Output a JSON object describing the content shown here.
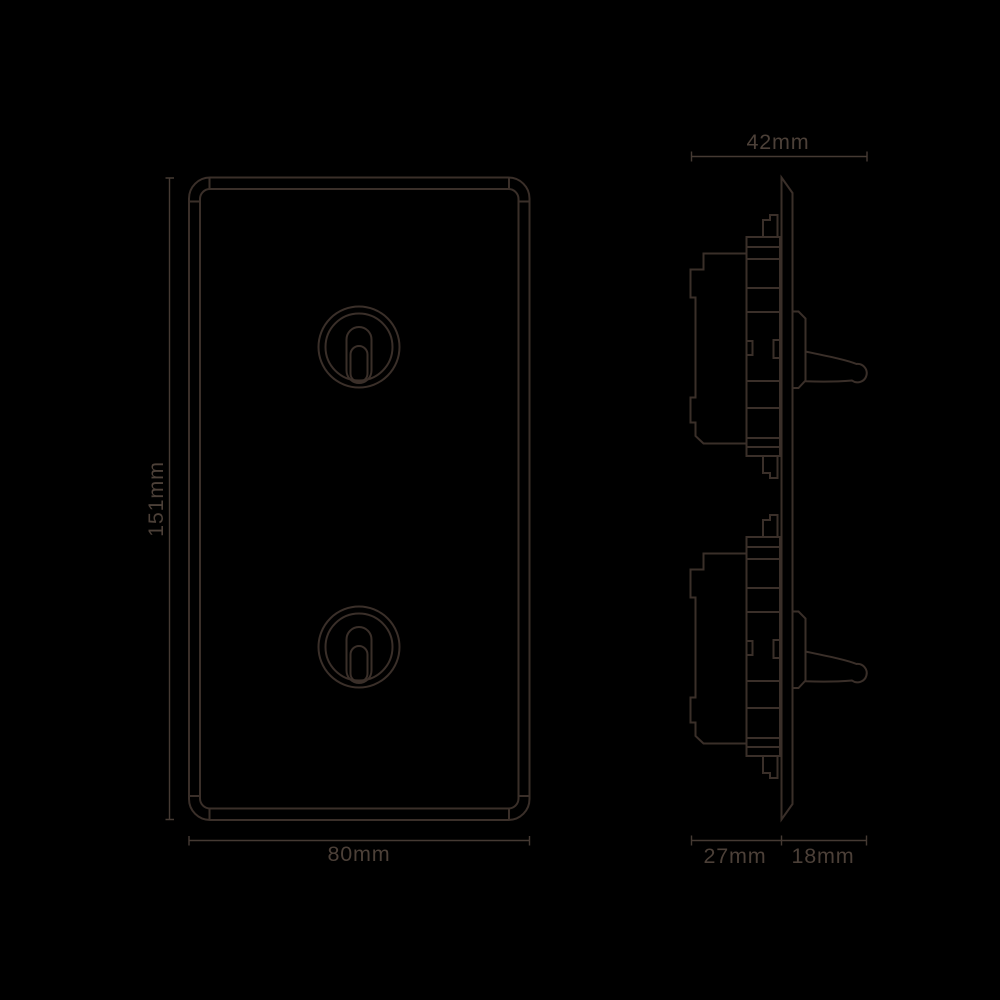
{
  "canvas": {
    "background_color": "#000000",
    "line_color": "#3a2f29",
    "dimension_line_color": "#453a33",
    "label_color": "#4c4038"
  },
  "front_view": {
    "height_label": "151mm",
    "width_label": "80mm"
  },
  "side_view": {
    "overall_depth_label": "42mm",
    "recessed_depth_label": "27mm",
    "projection_depth_label": "18mm"
  }
}
